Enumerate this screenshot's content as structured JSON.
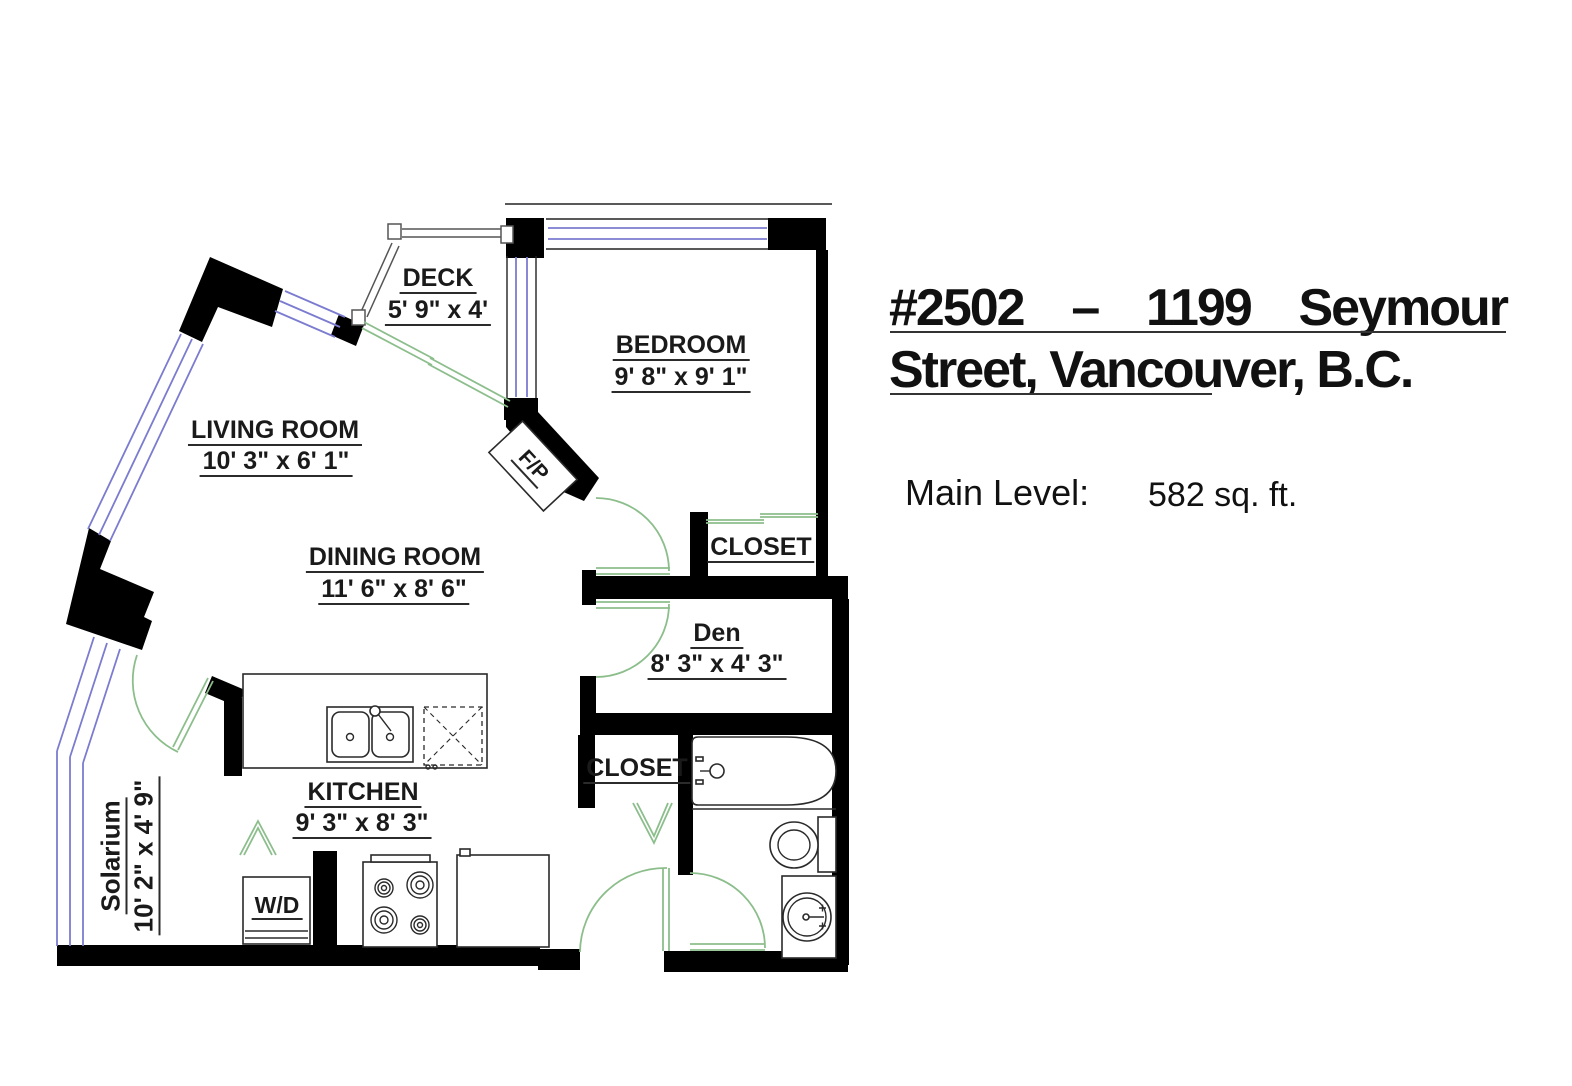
{
  "colors": {
    "wall": "#000000",
    "window": "#7b7bd0",
    "door": "#8cbe8c",
    "railing": "#555555",
    "ink": "#1a1a1a"
  },
  "header": {
    "title_words": {
      "w1": "#2502",
      "w2": "–",
      "w3": "1199",
      "w4": "Seymour"
    },
    "title_line2": "Street, Vancouver, B.C.",
    "level_label": "Main Level:",
    "level_area": "582 sq. ft."
  },
  "rooms": {
    "deck": {
      "name": "DECK",
      "dims": "5' 9\" x 4'"
    },
    "bedroom": {
      "name": "BEDROOM",
      "dims": "9' 8\" x 9' 1\""
    },
    "living_room": {
      "name": "LIVING ROOM",
      "dims": "10' 3\" x 6' 1\""
    },
    "dining_room": {
      "name": "DINING ROOM",
      "dims": "11' 6\" x 8' 6\""
    },
    "bedroom_closet": {
      "name": "CLOSET"
    },
    "den": {
      "name": "Den",
      "dims": "8' 3\" x 4' 3\""
    },
    "hall_closet": {
      "name": "CLOSET"
    },
    "kitchen": {
      "name": "KITCHEN",
      "dims": "9' 3\" x 8' 3\""
    },
    "solarium": {
      "name": "Solarium",
      "dims": "10' 2\" x 4' 9\""
    },
    "laundry": {
      "name": "W/D"
    },
    "fireplace": {
      "name": "F/P"
    }
  }
}
